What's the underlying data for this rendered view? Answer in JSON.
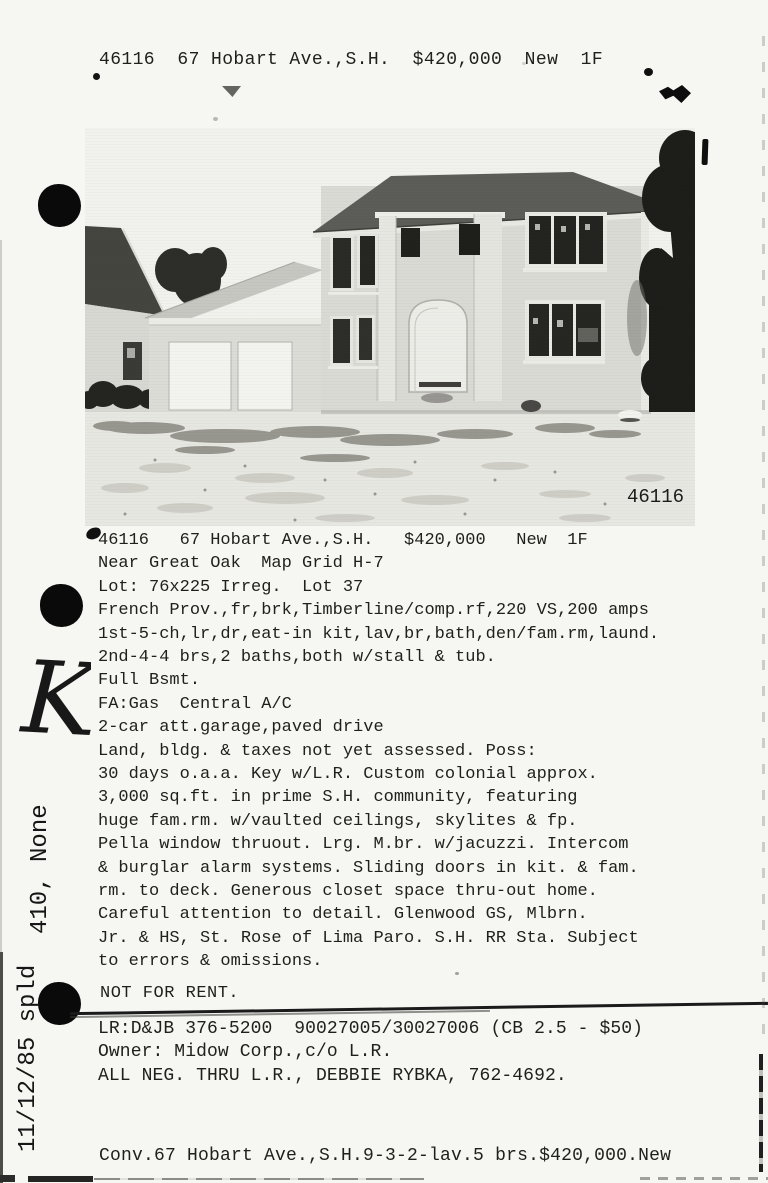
{
  "header": {
    "line": "46116  67 Hobart Ave.,S.H.  $420,000  New  1F"
  },
  "photo": {
    "id_label": "46116"
  },
  "listing": {
    "lines": [
      "46116   67 Hobart Ave.,S.H.   $420,000   New  1F",
      "Near Great Oak  Map Grid H-7",
      "Lot: 76x225 Irreg.  Lot 37",
      "French Prov.,fr,brk,Timberline/comp.rf,220 VS,200 amps",
      "1st-5-ch,lr,dr,eat-in kit,lav,br,bath,den/fam.rm,laund.",
      "2nd-4-4 brs,2 baths,both w/stall & tub.",
      "Full Bsmt.",
      "FA:Gas  Central A/C",
      "2-car att.garage,paved drive",
      "Land, bldg. & taxes not yet assessed. Poss:",
      "30 days o.a.a. Key w/L.R. Custom colonial approx.",
      "3,000 sq.ft. in prime S.H. community, featuring",
      "huge fam.rm. w/vaulted ceilings, skylites & fp.",
      "Pella window thruout. Lrg. M.br. w/jacuzzi. Intercom",
      "& burglar alarm systems. Sliding doors in kit. & fam.",
      "rm. to deck. Generous closet space thru-out home.",
      "Careful attention to detail. Glenwood GS, Mlbrn.",
      "Jr. & HS, St. Rose of Lima Paro. S.H. RR Sta. Subject",
      "to errors & omissions."
    ]
  },
  "status": {
    "not_for_rent": "NOT FOR RENT."
  },
  "agent": {
    "lines": [
      "LR:D&JB 376-5200  90027005/30027006 (CB 2.5 - $50)",
      "Owner: Midow Corp.,c/o L.R.",
      "ALL NEG. THRU L.R., DEBBIE RYBKA, 762-4692."
    ]
  },
  "footer": {
    "line": "Conv.67 Hobart Ave.,S.H.9-3-2-lav.5 brs.$420,000.New"
  },
  "margin_notes": {
    "handwritten_letter": "K",
    "code_note": "410, None",
    "date_note": "11/12/85 spld"
  },
  "colors": {
    "ink": "#1f1f1d",
    "paper": "#f6f6f2",
    "photo_sky": "#f1f1ed",
    "photo_ground": "#e7e7e1",
    "roof_dark": "#5c5c58",
    "tree_dark": "#1d1d1a",
    "punch_black": "#0a0a0a"
  }
}
